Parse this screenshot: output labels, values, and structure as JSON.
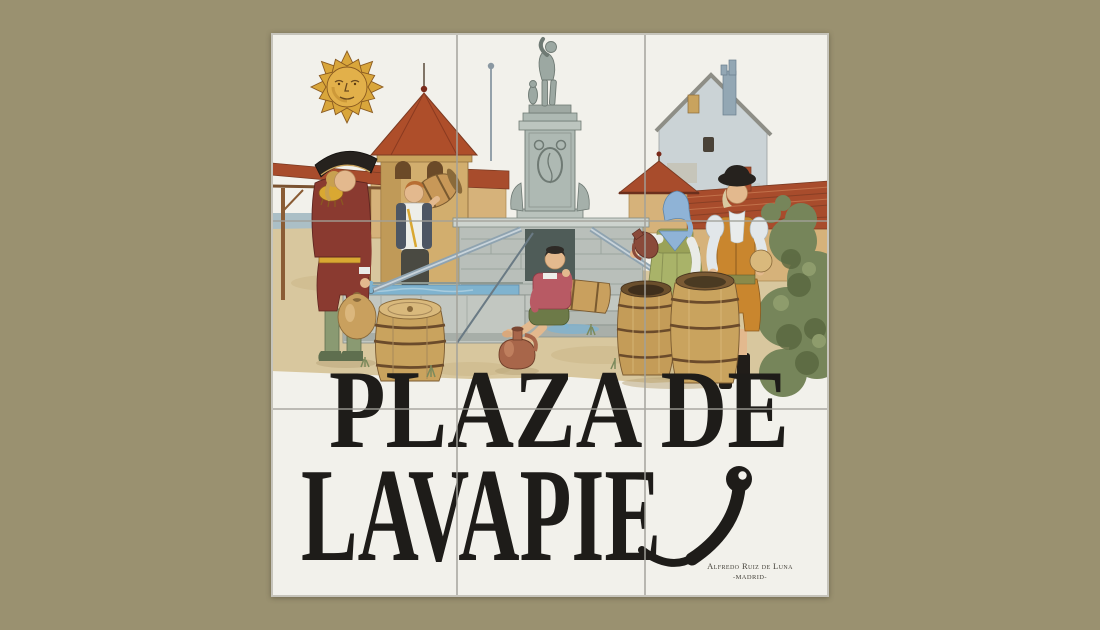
{
  "page": {
    "background_color": "#9A9170",
    "subject": "Ceramic tile street sign of Plaza de Lavapies, Madrid, painted with a fountain scene"
  },
  "sign": {
    "kind": "ceramic-tile-street-sign",
    "tiles": {
      "rows": 3,
      "cols": 3
    },
    "tile_color": "#F2F1EB",
    "grout_color": "#A2A19A",
    "text_color": "#1E1C19",
    "title": {
      "line1": "PLAZA DE",
      "line2_painted": "LAVAPIE",
      "line2_swash_letter": "S",
      "full_text": "PLAZA DE LAVAPIES"
    },
    "signature": {
      "line1": "Alfredo Ruiz de Luna",
      "line2": "-MADRID-"
    }
  },
  "scene": {
    "elements": [
      "sun-with-face",
      "pergola",
      "turret-red-roof",
      "lightning-rod",
      "gable-house",
      "red-tile-roof",
      "kiosk-roof",
      "fountain-statue",
      "fountain-pedestal",
      "fountain-wall",
      "water-trough",
      "water-pipes",
      "water-carrier-man",
      "boy-carrying-keg",
      "seated-boy-with-keg",
      "woman-pouring-jug",
      "man-in-ochre-suit",
      "wooden-barrels",
      "clay-jug",
      "green-bush",
      "sandy-ground"
    ],
    "colors": {
      "sun_gold": "#DFA93C",
      "roof_red": "#A84C2C",
      "wall_tan": "#D2AE6E",
      "stone_gray": "#AEB9B3",
      "water_blue": "#7FB3CF",
      "sand": "#D8C79E",
      "costume_maroon": "#8A3A30",
      "costume_ochre": "#C9862E",
      "dress_green": "#A9B369",
      "scarf_blue": "#8FB3D6",
      "barrel_tan": "#C9A35E",
      "foliage_green": "#76855A",
      "hat_black": "#26221E"
    }
  }
}
